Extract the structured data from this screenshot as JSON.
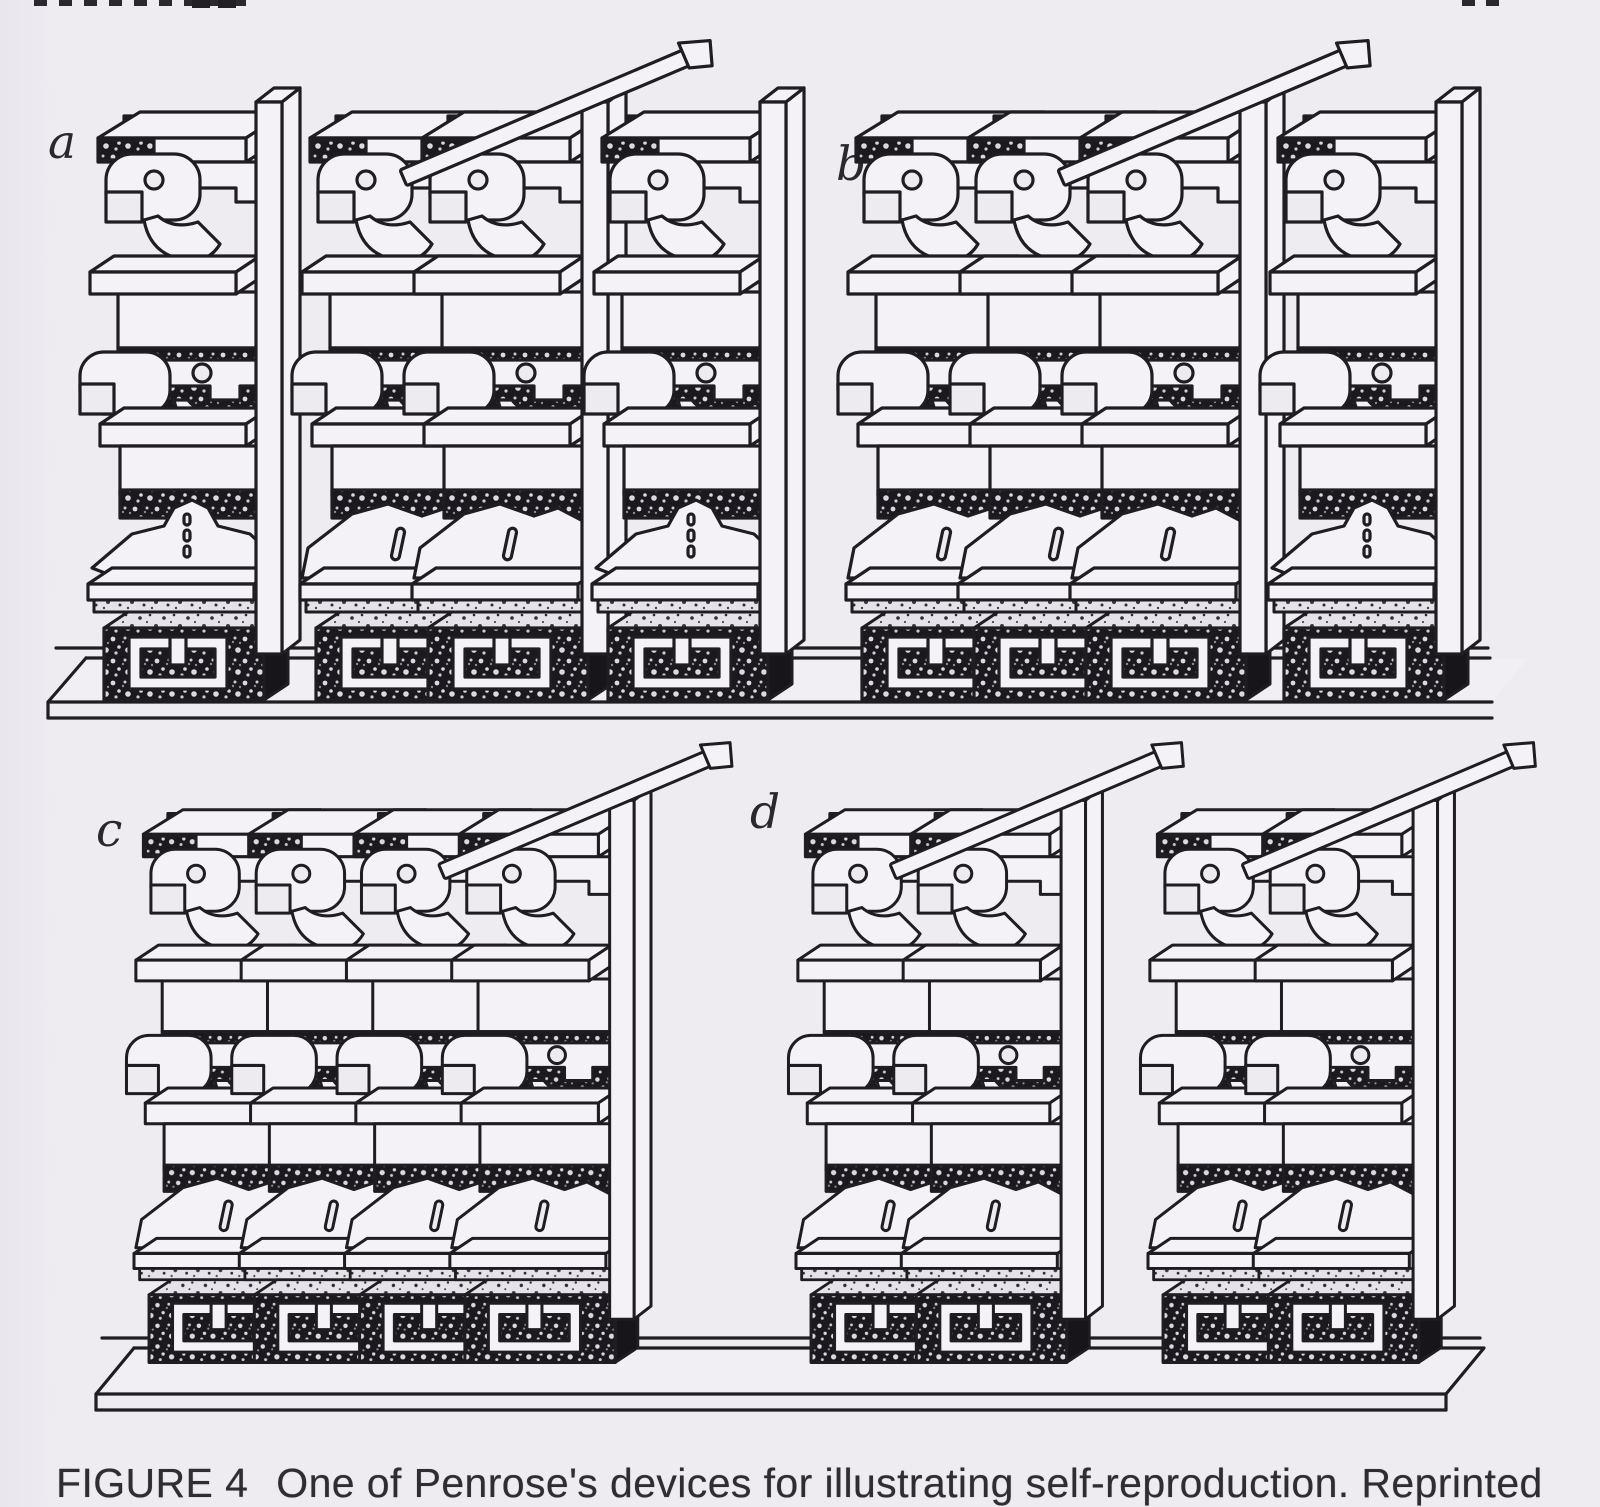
{
  "figure": {
    "caption": {
      "label": "FIGURE 4",
      "text": "One of Penrose's devices for illustrating self-reproduction. Reprinted"
    },
    "panels": [
      {
        "label": "a",
        "unit_groups": [
          1,
          2,
          1
        ]
      },
      {
        "label": "b",
        "unit_groups": [
          3,
          1
        ]
      },
      {
        "label": "c",
        "unit_groups": [
          4
        ]
      },
      {
        "label": "d",
        "unit_groups": [
          2,
          2
        ]
      }
    ],
    "colors": {
      "paper": "#edeaf0",
      "ink": "#1f1d20",
      "block_face": "#f4f2f6"
    }
  }
}
